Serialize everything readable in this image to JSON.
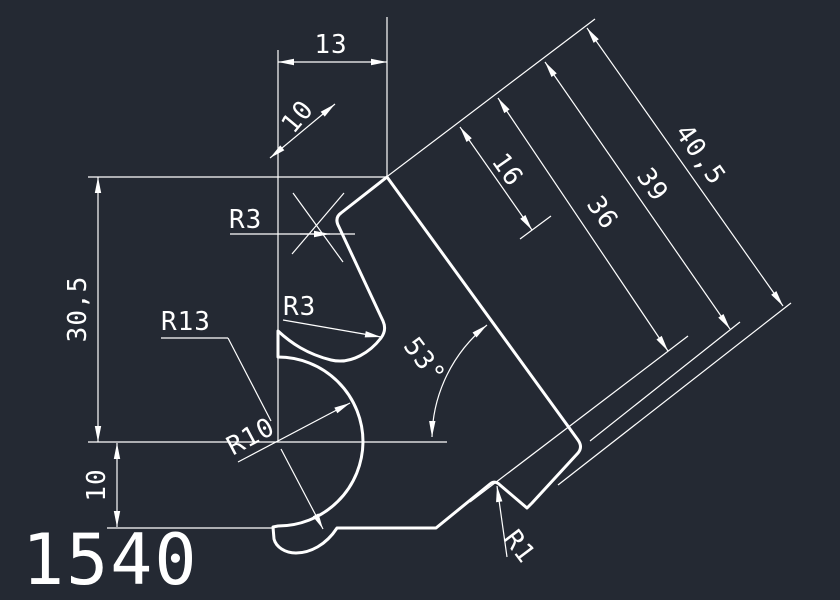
{
  "drawing": {
    "part_label": "1540",
    "colors": {
      "background": "#242933",
      "line": "#ffffff"
    },
    "dims": {
      "d13": "13",
      "d10_top": "10",
      "d16": "16",
      "d36": "36",
      "d39": "39",
      "d40_5": "40,5",
      "d30_5": "30,5",
      "d10_left": "10",
      "angle": "53°",
      "r3_top": "R3",
      "r3_mid": "R3",
      "r13": "R13",
      "r10": "R10",
      "r1": "R1"
    }
  }
}
